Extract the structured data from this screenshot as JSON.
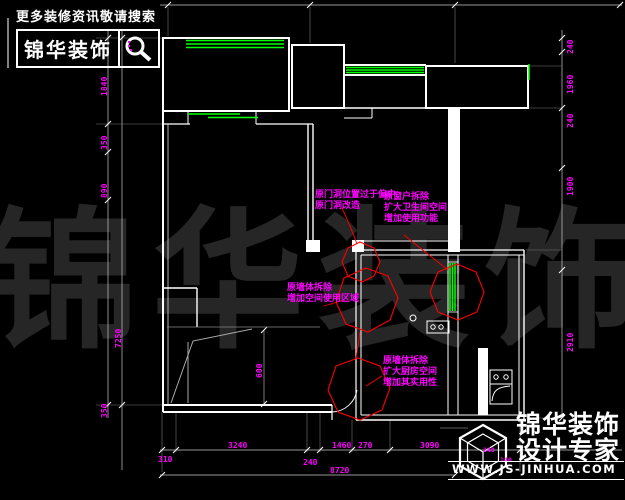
{
  "watermark": {
    "text": "锦华装饰"
  },
  "branding": {
    "top": {
      "tagline": "更多装修资讯敬请搜索",
      "brand": "锦华装饰",
      "icon": "magnifier-icon"
    },
    "bottom": {
      "brand_line1": "锦华装饰",
      "brand_line2": "设计专家",
      "website": "WWW.JS-JINHUA.COM",
      "icon": "cube-logo-icon"
    }
  },
  "annotations": [
    {
      "lines": [
        "原门洞位置过于偏中",
        "原门洞改造"
      ]
    },
    {
      "lines": [
        "原窗户拆除",
        "扩大卫生间空间",
        "增加使用功能"
      ]
    },
    {
      "lines": [
        "原墙体拆除",
        "增加空间使用区域"
      ]
    },
    {
      "lines": [
        "原墙体拆除",
        "扩大厨房空间",
        "增加其实用性"
      ]
    }
  ],
  "dimensions": {
    "left": [
      "1840",
      "350",
      "890",
      "350"
    ],
    "left_total": "7250",
    "right": [
      "240",
      "1960",
      "240",
      "1900",
      "2910"
    ],
    "bottom": [
      "310",
      "3240",
      "240",
      "1460",
      "270",
      "3090"
    ],
    "bottom_total": "8720",
    "interior": [
      "600"
    ],
    "small": [
      "240",
      "140"
    ]
  },
  "colors": {
    "background": "#000000",
    "walls": "#ffffff",
    "windows": "#00ff00",
    "dimensions_text": "#ff00ff",
    "revision_clouds": "#ff0000",
    "watermark": "#262626"
  }
}
